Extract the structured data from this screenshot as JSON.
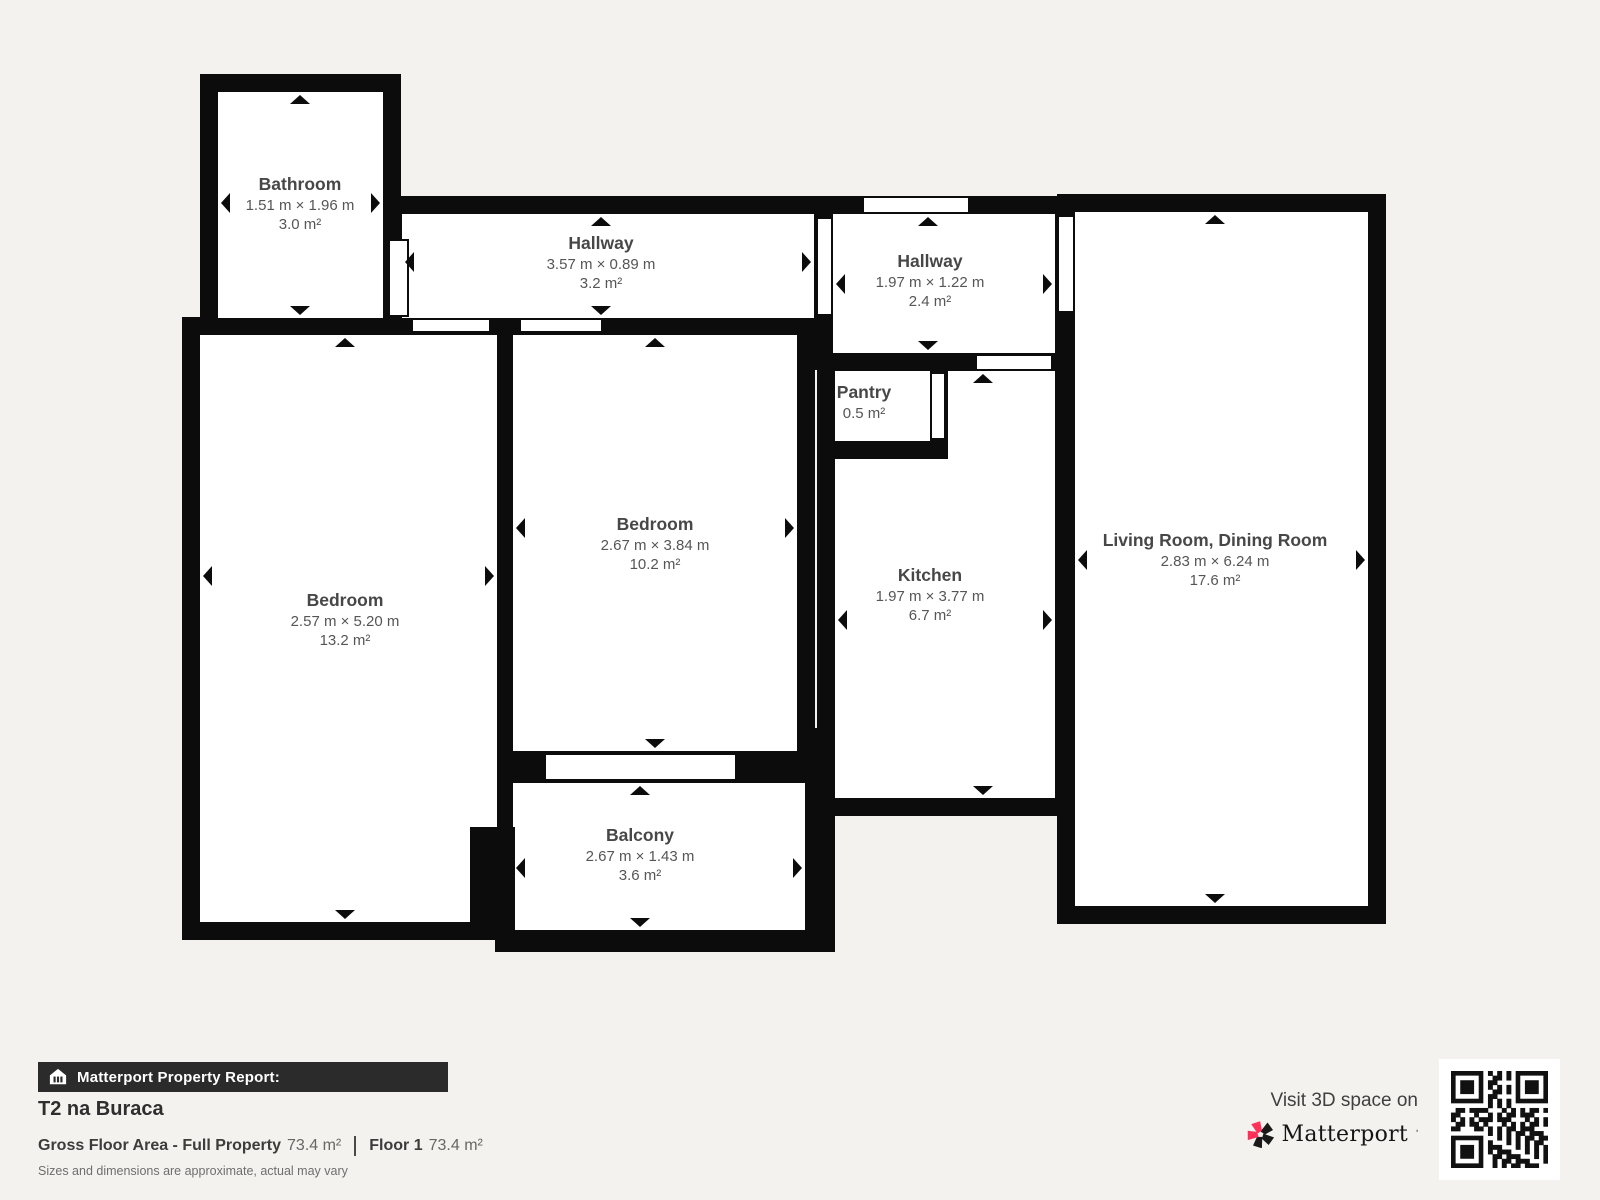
{
  "plan": {
    "rooms": [
      {
        "id": "bathroom",
        "name": "Bathroom",
        "dims": "1.51 m × 1.96 m",
        "area": "3.0 m²"
      },
      {
        "id": "hallway-top",
        "name": "Hallway",
        "dims": "3.57 m × 0.89 m",
        "area": "3.2 m²"
      },
      {
        "id": "hallway-right",
        "name": "Hallway",
        "dims": "1.97 m × 1.22 m",
        "area": "2.4 m²"
      },
      {
        "id": "pantry",
        "name": "Pantry",
        "dims": "",
        "area": "0.5 m²"
      },
      {
        "id": "bedroom-left",
        "name": "Bedroom",
        "dims": "2.57 m × 5.20 m",
        "area": "13.2 m²"
      },
      {
        "id": "bedroom-middle",
        "name": "Bedroom",
        "dims": "2.67 m × 3.84 m",
        "area": "10.2 m²"
      },
      {
        "id": "kitchen",
        "name": "Kitchen",
        "dims": "1.97 m × 3.77 m",
        "area": "6.7 m²"
      },
      {
        "id": "living-room",
        "name": "Living Room, Dining Room",
        "dims": "2.83 m × 6.24 m",
        "area": "17.6 m²"
      },
      {
        "id": "balcony",
        "name": "Balcony",
        "dims": "2.67 m × 1.43 m",
        "area": "3.6 m²"
      }
    ]
  },
  "footer": {
    "report_label": "Matterport Property Report:",
    "property_name": "T2 na Buraca",
    "gross_label": "Gross Floor Area - Full Property",
    "gross_value": "73.4 m²",
    "floor_label": "Floor 1",
    "floor_value": "73.4 m²",
    "disclaimer": "Sizes and dimensions are approximate, actual may vary"
  },
  "promo": {
    "visit_text": "Visit 3D space on",
    "brand": "Matterport"
  },
  "colors": {
    "background": "#f3f2ef",
    "wall": "#0c0c0c",
    "room_fill": "#ffffff",
    "label_text": "#474747",
    "bar_background": "#2b2b2b",
    "brand_pink": "#ff3158"
  }
}
